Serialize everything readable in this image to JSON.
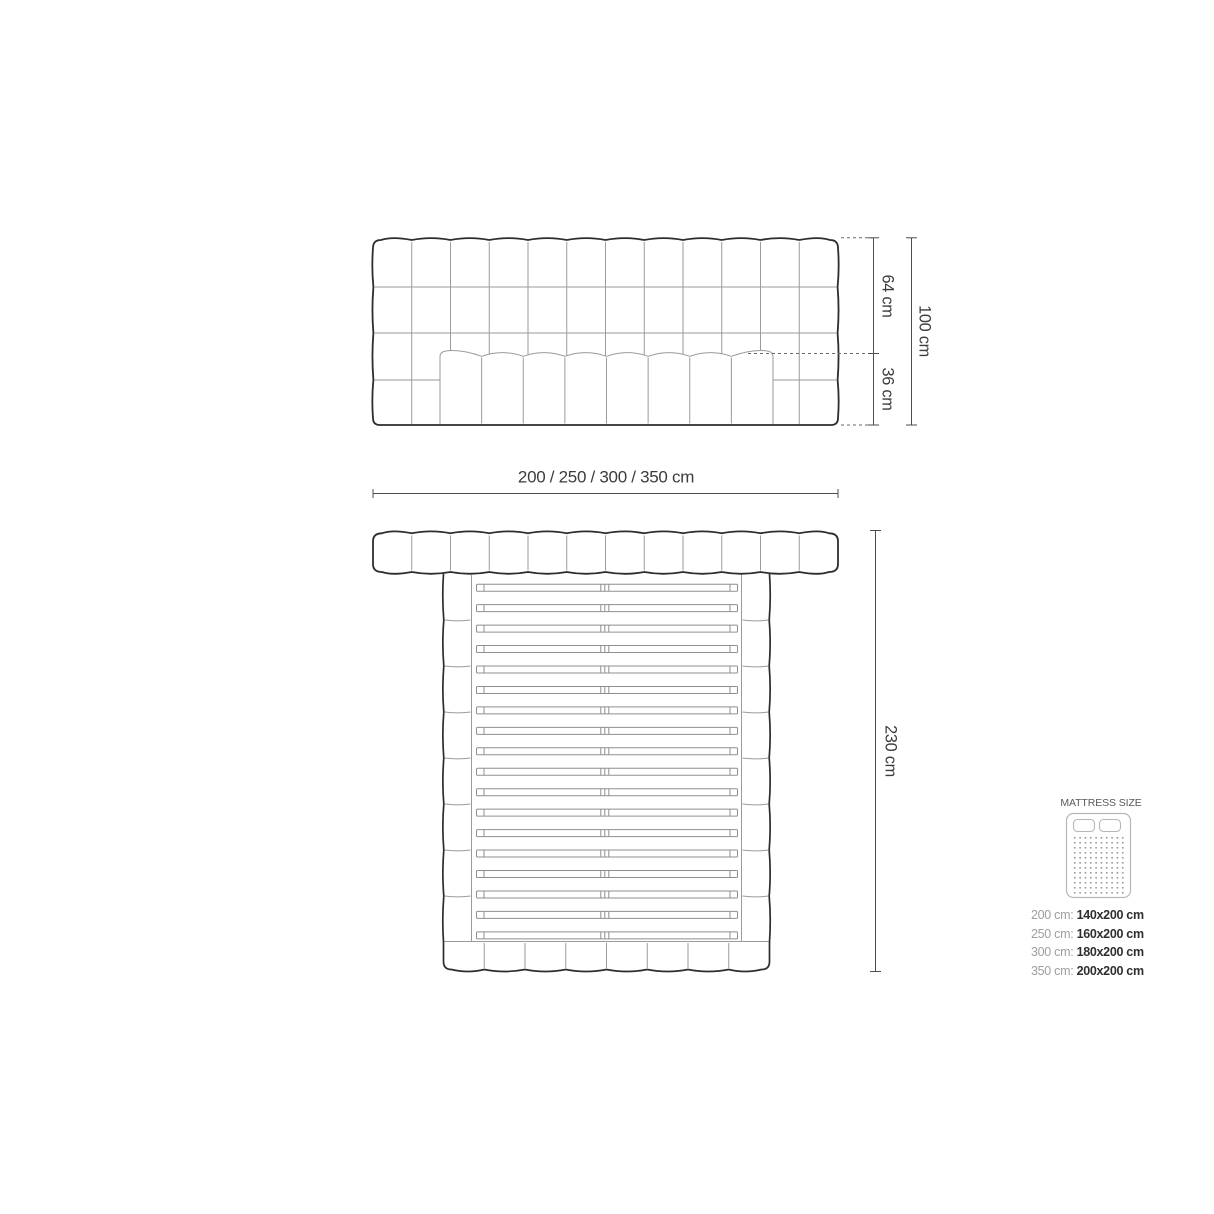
{
  "front_view": {
    "dims": {
      "upper": "64 cm",
      "lower": "36 cm",
      "total": "100 cm",
      "width": "200 / 250 / 300 / 350 cm"
    },
    "tuft_columns": 12,
    "tuft_rows": 4,
    "mattress_segments": 8
  },
  "plan_view": {
    "dims": {
      "length": "230 cm"
    },
    "headboard_segments": 12,
    "slat_count": 18,
    "footboard_segments": 8
  },
  "legend": {
    "title": "MATTRESS SIZE",
    "sizes": [
      {
        "label": "200 cm:",
        "value": "140x200 cm"
      },
      {
        "label": "250 cm:",
        "value": "160x200 cm"
      },
      {
        "label": "300 cm:",
        "value": "180x200 cm"
      },
      {
        "label": "350 cm:",
        "value": "200x200 cm"
      }
    ]
  },
  "colors": {
    "outline": "#2d2d2d",
    "detail": "#9a9a9a",
    "slat": "#8f8f8f",
    "dimension": "#4d4d4d",
    "dashed": "#6a6a6a",
    "text": "#3c3c3c",
    "legend_icon": "#b7b7b7",
    "legend_dot": "#9c9c9c"
  }
}
